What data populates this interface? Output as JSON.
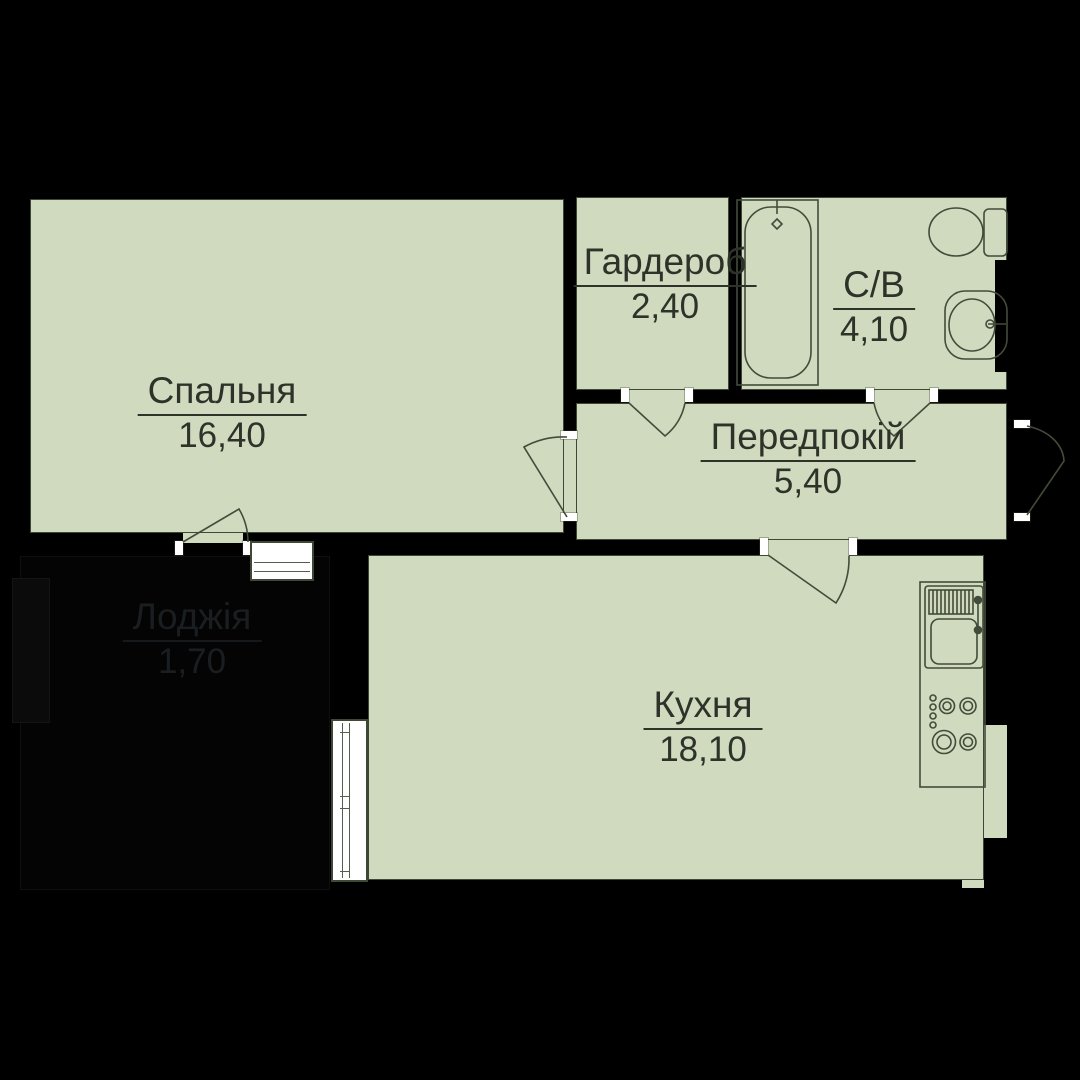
{
  "title": "Однокімнатна квартира — план (floor plan)",
  "rooms": [
    {
      "id": "bedroom",
      "name": "Спальня",
      "area": "16,40"
    },
    {
      "id": "wardrobe",
      "name": "Гардероб",
      "area": "2,40"
    },
    {
      "id": "bathroom",
      "name": "С/В",
      "area": "4,10"
    },
    {
      "id": "hallway",
      "name": "Передпокій",
      "area": "5,40"
    },
    {
      "id": "kitchen",
      "name": "Кухня",
      "area": "18,10"
    },
    {
      "id": "loggia",
      "name": "Лоджія",
      "area": "1,70"
    }
  ],
  "colors": {
    "room_fill": "#cfdabe",
    "wall": "#000000",
    "line": "#434b3a",
    "label_text": "#2e332a",
    "loggia_fill": "#040404",
    "loggia_text": "#1a1e21",
    "jamb_tick": "#ffffff"
  },
  "fixtures": [
    "bathtub",
    "bath-faucet",
    "toilet",
    "wash-sink",
    "vent-shaft",
    "kitchen-counter",
    "kitchen-sink",
    "kitchen-faucet",
    "stove-burners",
    "stove-knobs",
    "balcony-door-window",
    "kitchen-window",
    "loggia-window",
    "entrance-door"
  ]
}
